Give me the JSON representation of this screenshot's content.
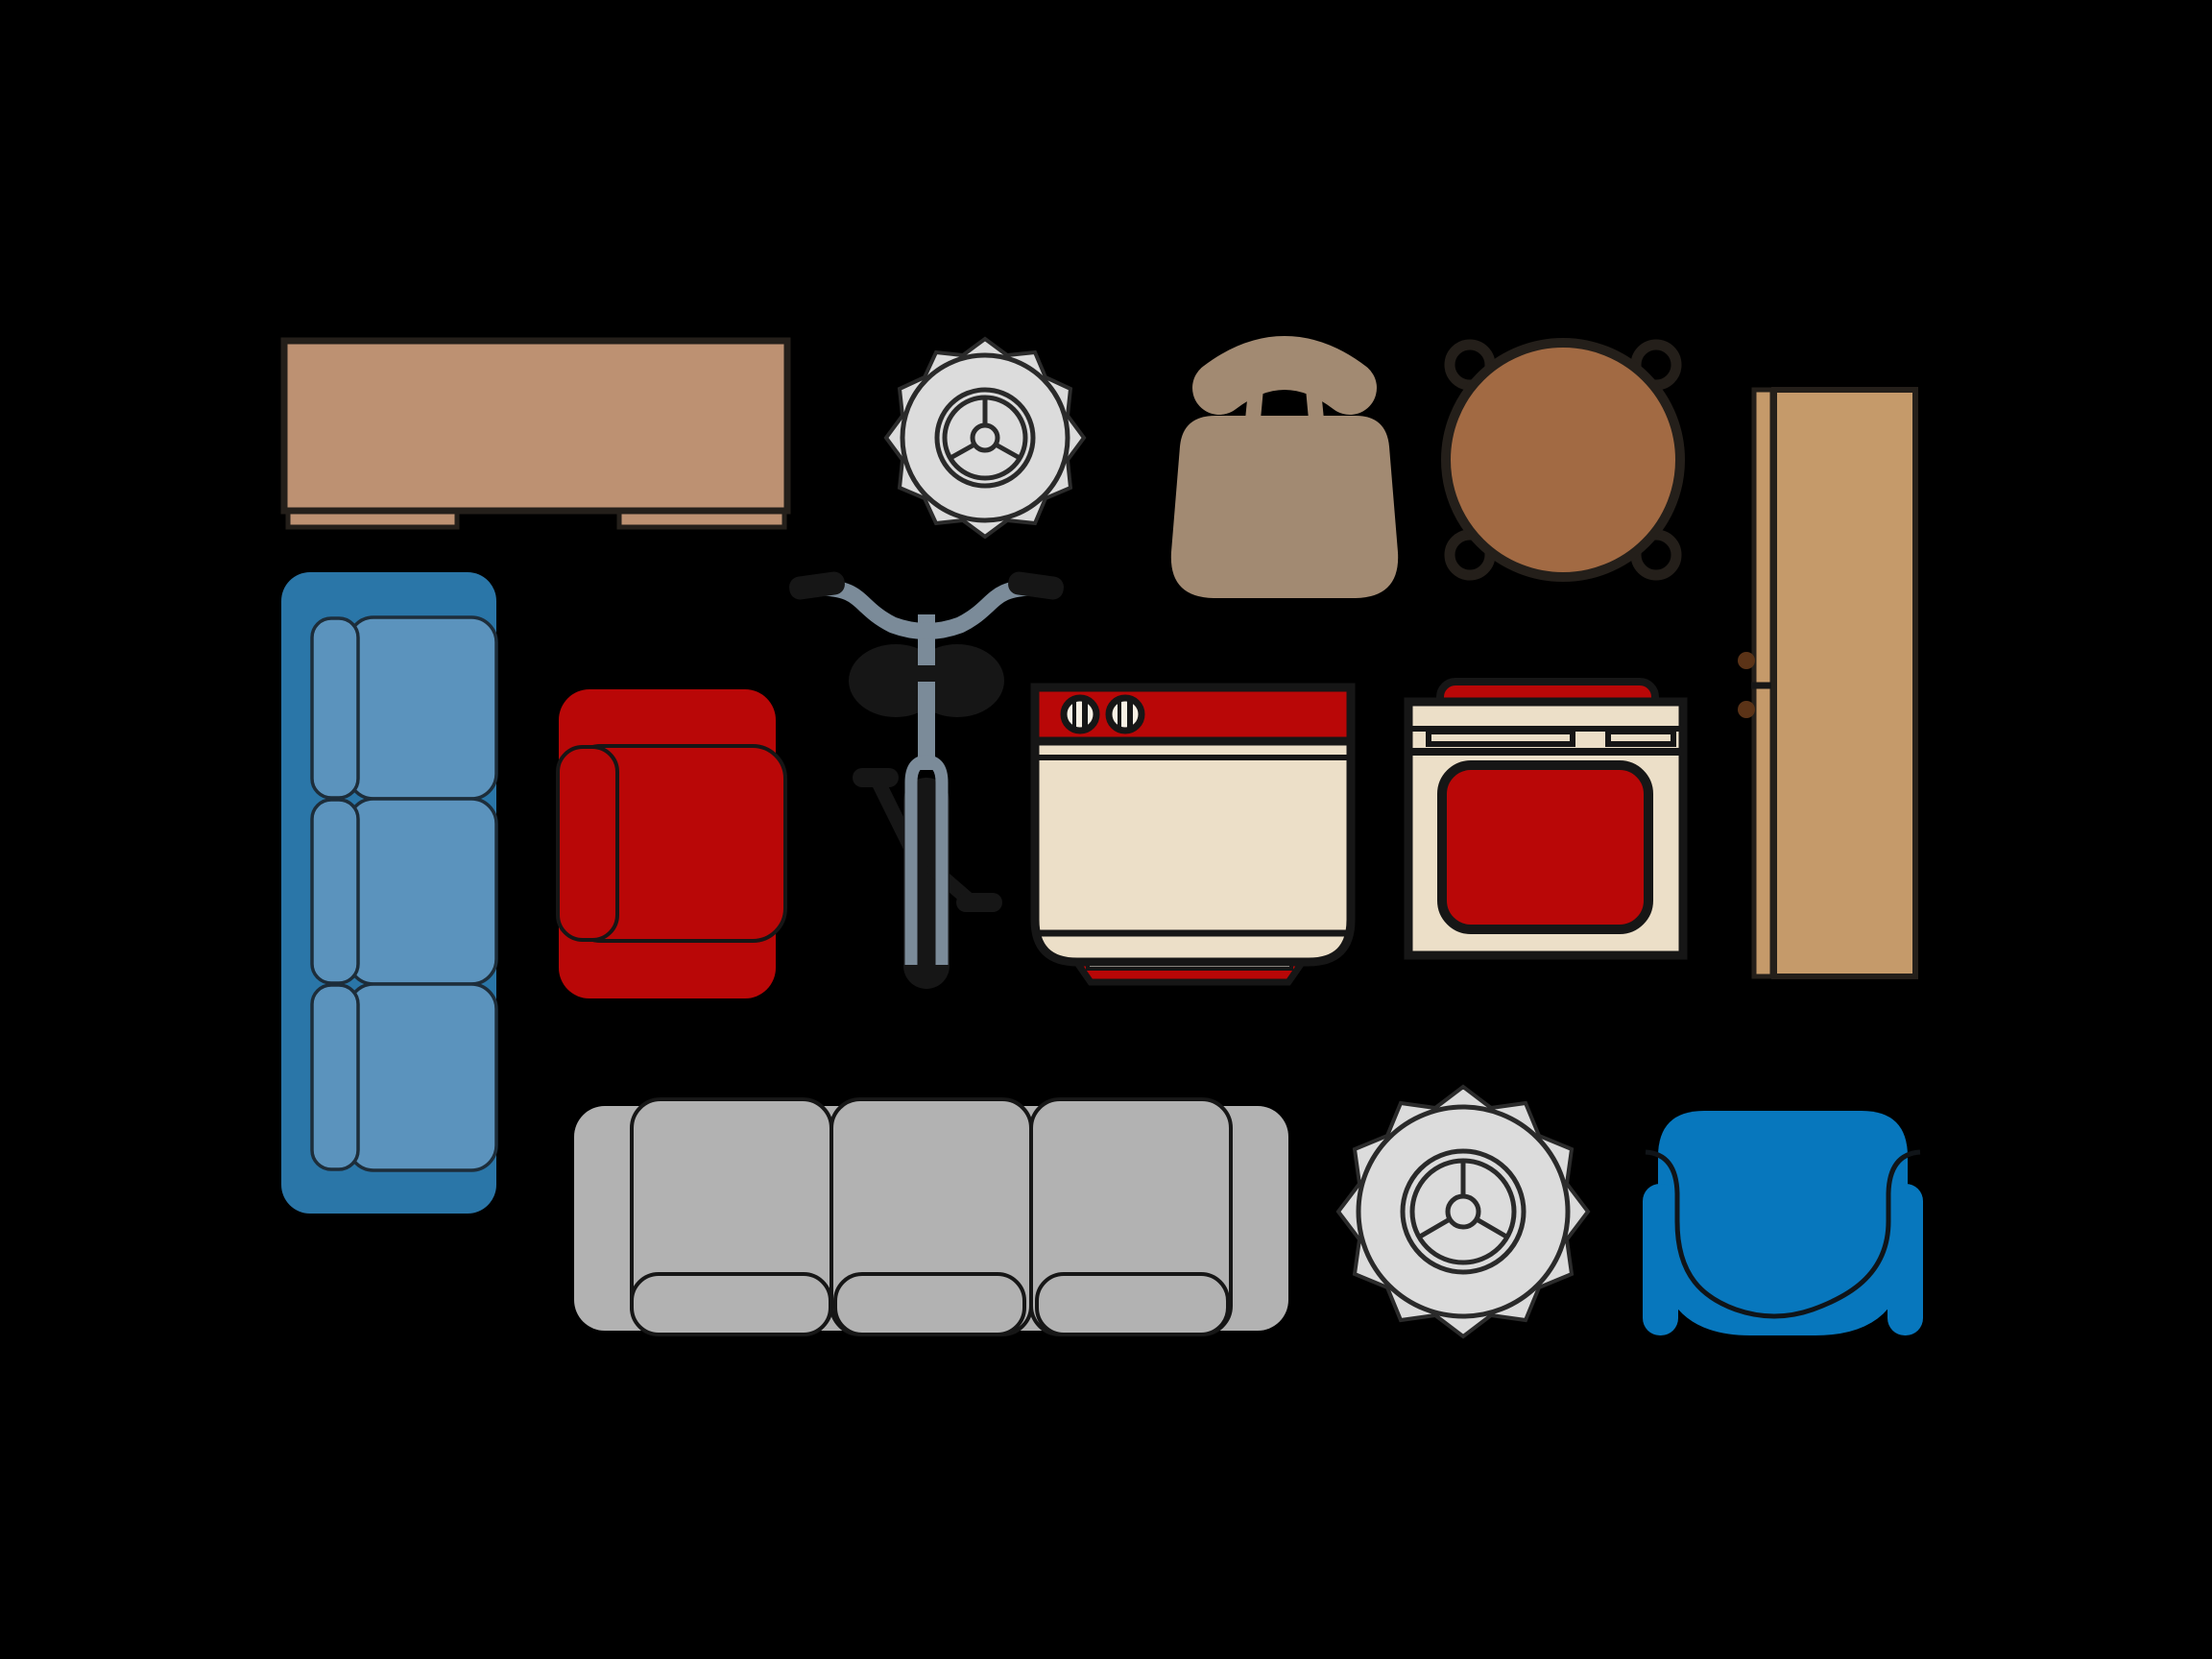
{
  "scene": {
    "description": "furniture-and-appliance-icon-sheet-on-black",
    "background": "#000000"
  },
  "colors": {
    "bg": "#000000",
    "tan": "#bd9172",
    "taupe": "#a28a72",
    "brown": "#a26a43",
    "wood": "#c59a6a",
    "blue_dark": "#2a76a8",
    "blue_light": "#5b93bd",
    "red": "#b90707",
    "cream": "#ecdfc8",
    "cream_light": "#f7f0e4",
    "gray": "#b2b2b2",
    "flower_gray": "#dcdcdc",
    "blue_chair": "#0777bd",
    "bike_frame": "#7b8b99",
    "ink": "#161616",
    "outline": "#241f1a",
    "soft_line": "#2a2a2a",
    "navy": "#1d2d3a",
    "handle": "#5b3317"
  },
  "items": [
    {
      "name": "sideboard-table",
      "color": "#bd9172"
    },
    {
      "name": "potted-plant-top-view-1",
      "color": "#dcdcdc"
    },
    {
      "name": "dining-chair-top-view",
      "color": "#a28a72"
    },
    {
      "name": "round-table-with-chairs",
      "color": "#a26a43"
    },
    {
      "name": "wardrobe-side-view",
      "color": "#c59a6a"
    },
    {
      "name": "blue-sofa-top-view",
      "color": "#2a76a8"
    },
    {
      "name": "red-armchair-top-view",
      "color": "#b90707"
    },
    {
      "name": "bicycle-front-view",
      "color": "#7b8b99"
    },
    {
      "name": "washing-machine",
      "color": "#ecdfc8"
    },
    {
      "name": "stove-oven",
      "color": "#ecdfc8"
    },
    {
      "name": "gray-sofa-top-view",
      "color": "#b2b2b2"
    },
    {
      "name": "potted-plant-top-view-2",
      "color": "#dcdcdc"
    },
    {
      "name": "blue-tub-chair-top-view",
      "color": "#0777bd"
    }
  ]
}
